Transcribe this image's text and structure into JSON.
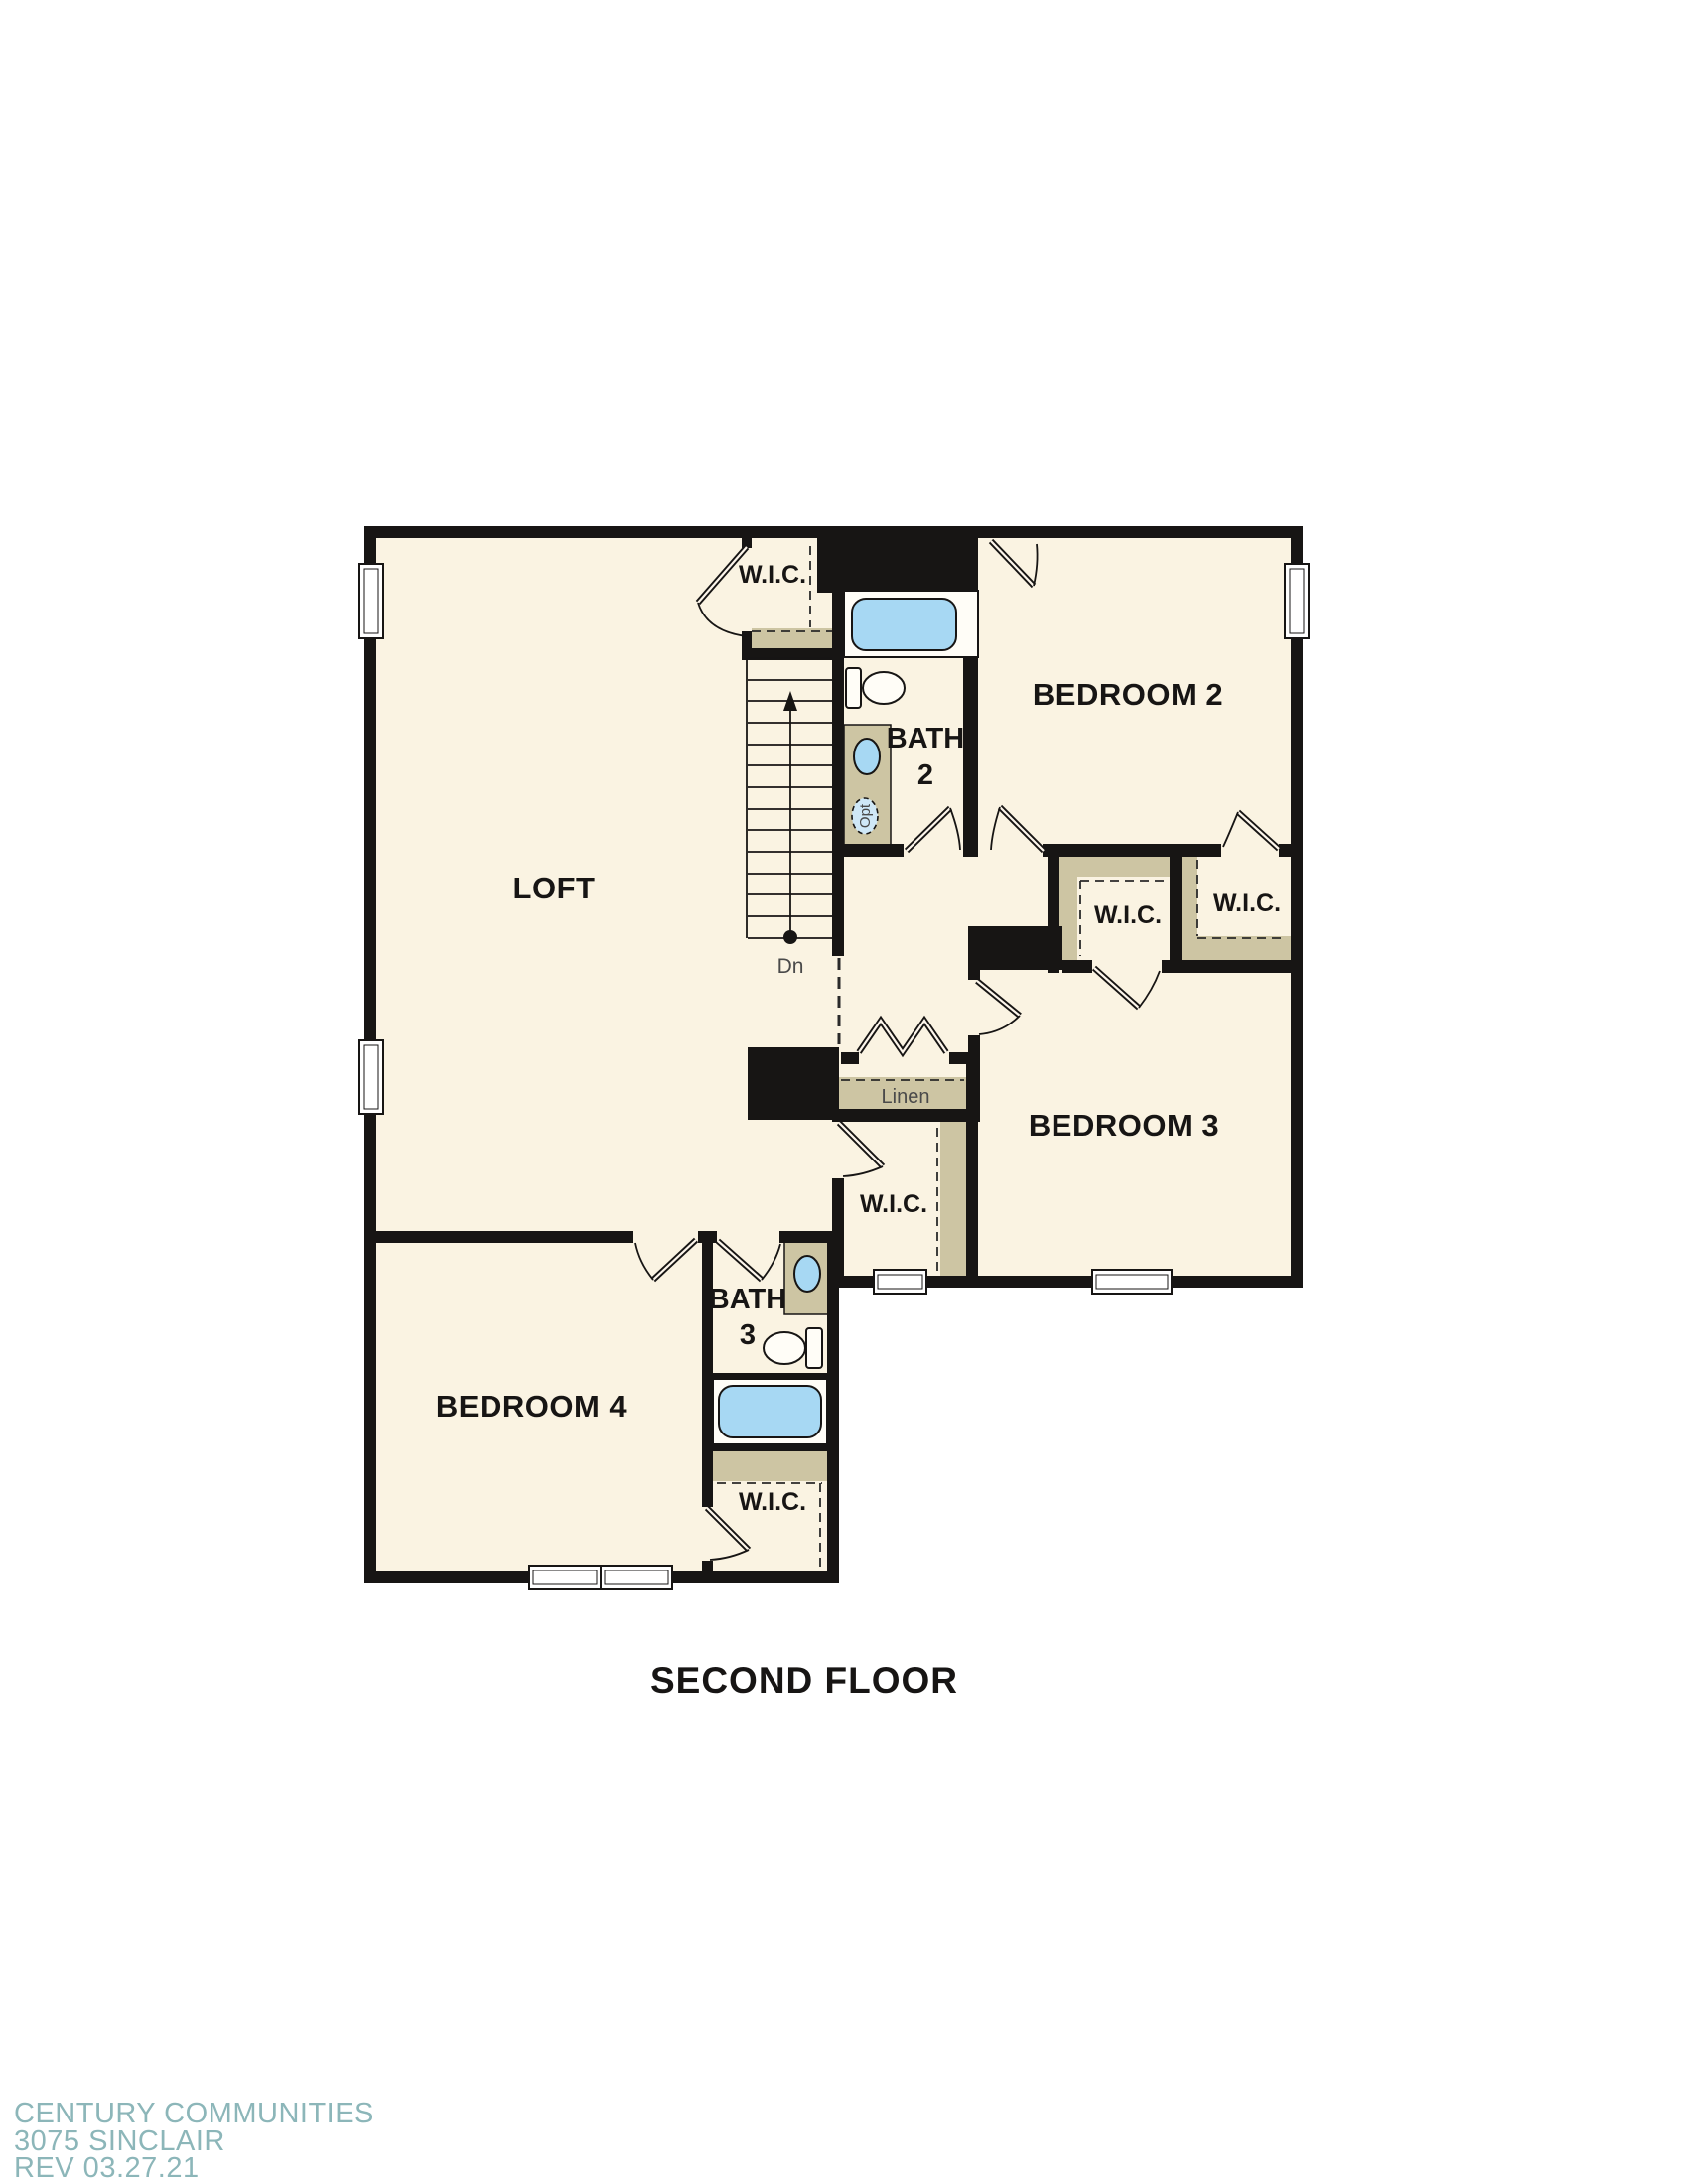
{
  "plan": {
    "title": "SECOND FLOOR",
    "rooms": {
      "loft": "LOFT",
      "bedroom2": "BEDROOM 2",
      "bedroom3": "BEDROOM 3",
      "bedroom4": "BEDROOM 4"
    },
    "baths": {
      "bath2": [
        "BATH",
        "2"
      ],
      "bath3": [
        "BATH",
        "3"
      ]
    },
    "closets": {
      "wic": "W.I.C.",
      "linen": "Linen"
    },
    "stairs": {
      "down": "Dn"
    },
    "fixtures": {
      "optional_sink": "Opt"
    },
    "colors": {
      "wall": "#171514",
      "floor": "#faf3e2",
      "casework": "#cdc5a3",
      "water_fixture": "#a7d8f3",
      "footer_text": "#8cb6b9"
    }
  },
  "footer": {
    "line1": "CENTURY COMMUNITIES",
    "line2": "3075 SINCLAIR",
    "line3": "REV 03.27.21"
  }
}
